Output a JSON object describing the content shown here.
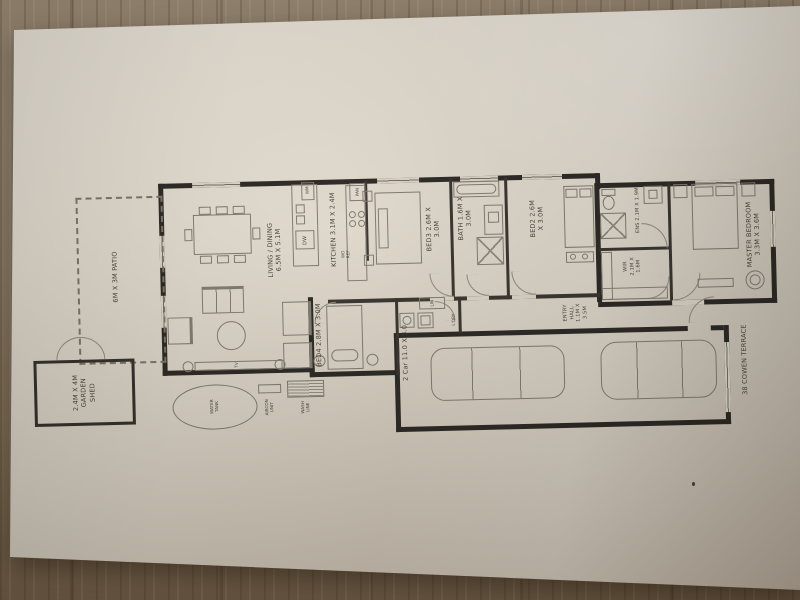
{
  "floorplan": {
    "address": "38 COWEN TERRACE",
    "rooms": {
      "living": {
        "lines": [
          "LIVING / DINING",
          "6.5M X 5.1M"
        ]
      },
      "kitchen": {
        "lines": [
          "KITCHEN 3.1M X 2.4M"
        ]
      },
      "bed3": {
        "lines": [
          "BED3 2.6M X",
          "3.0M"
        ]
      },
      "bath": {
        "lines": [
          "BATH 1.6M X",
          "3.0M"
        ]
      },
      "bed2": {
        "lines": [
          "BED2 2.6M",
          "X 3.0M"
        ]
      },
      "ens": {
        "lines": [
          "ENS 2.1M X 1.9M"
        ]
      },
      "wir": {
        "lines": [
          "WIR",
          "2.1M X",
          "1.6M"
        ]
      },
      "master": {
        "lines": [
          "MASTER BEDROOM",
          "3.3M X 3.6M"
        ]
      },
      "entry": {
        "lines": [
          "ENTRY",
          "HALL",
          "1.1M X",
          "3.5M"
        ]
      },
      "bed4": {
        "lines": [
          "BED4 2.8M X 3.0M"
        ]
      },
      "garage": {
        "lines": [
          "2 Car 11.0 X 3.0"
        ]
      }
    },
    "outdoor": {
      "patio": {
        "lines": [
          "6M X 3M PATIO"
        ]
      },
      "shed": {
        "lines": [
          "2.4M X 4M",
          "GARDEN",
          "SHED"
        ]
      },
      "water_tank": {
        "lines": [
          "WATER",
          "TANK"
        ]
      },
      "aircon": {
        "lines": [
          "AIRCON",
          "UNIT"
        ]
      },
      "wash_line": {
        "lines": [
          "WASH",
          "LINE"
        ]
      }
    },
    "fixtures": {
      "dw": "DW",
      "pan": "PAN",
      "wm": "WM",
      "ldry": "L'DRY",
      "lin": "LIN",
      "tv": "TV",
      "wo": "WO",
      "ref": "REF"
    }
  }
}
